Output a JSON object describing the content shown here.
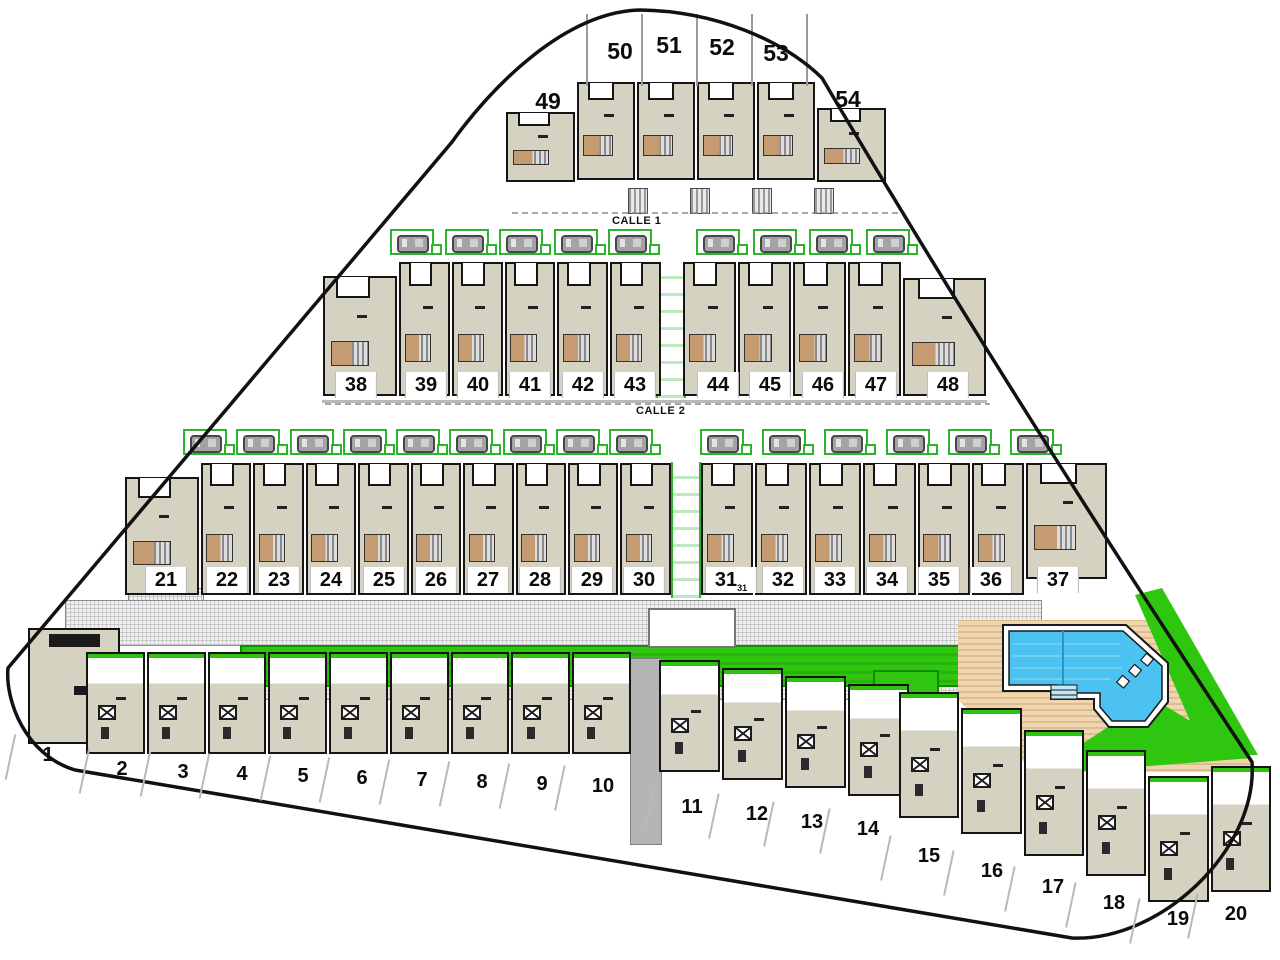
{
  "site": {
    "type": "residential-site-plan",
    "streets": [
      {
        "label": "CALLE 1"
      },
      {
        "label": "CALLE 2"
      }
    ],
    "total_plots": 54
  },
  "plots": {
    "rowA": {
      "plots": [
        {
          "n": "49",
          "x": 548,
          "y": 88
        },
        {
          "n": "50",
          "x": 620,
          "y": 38
        },
        {
          "n": "51",
          "x": 669,
          "y": 32
        },
        {
          "n": "52",
          "x": 722,
          "y": 34
        },
        {
          "n": "53",
          "x": 776,
          "y": 40
        },
        {
          "n": "54",
          "x": 848,
          "y": 86
        }
      ]
    },
    "rowB_left": {
      "plots": [
        {
          "n": "38",
          "x": 356,
          "y": 372
        },
        {
          "n": "39",
          "x": 426,
          "y": 372
        },
        {
          "n": "40",
          "x": 478,
          "y": 372
        },
        {
          "n": "41",
          "x": 530,
          "y": 372
        },
        {
          "n": "42",
          "x": 583,
          "y": 372
        },
        {
          "n": "43",
          "x": 635,
          "y": 372
        }
      ]
    },
    "rowB_right": {
      "plots": [
        {
          "n": "44",
          "x": 718,
          "y": 372
        },
        {
          "n": "45",
          "x": 770,
          "y": 372
        },
        {
          "n": "46",
          "x": 823,
          "y": 372
        },
        {
          "n": "47",
          "x": 876,
          "y": 372
        },
        {
          "n": "48",
          "x": 948,
          "y": 372
        }
      ]
    },
    "rowC_left": {
      "plots": [
        {
          "n": "21",
          "x": 166,
          "y": 567
        },
        {
          "n": "22",
          "x": 227,
          "y": 567
        },
        {
          "n": "23",
          "x": 279,
          "y": 567
        },
        {
          "n": "24",
          "x": 331,
          "y": 567
        },
        {
          "n": "25",
          "x": 384,
          "y": 567
        },
        {
          "n": "26",
          "x": 436,
          "y": 567
        },
        {
          "n": "27",
          "x": 488,
          "y": 567
        },
        {
          "n": "28",
          "x": 540,
          "y": 567
        },
        {
          "n": "29",
          "x": 592,
          "y": 567
        },
        {
          "n": "30",
          "x": 644,
          "y": 567
        }
      ]
    },
    "rowC_right": {
      "plots": [
        {
          "n": "31",
          "sub": "31",
          "x": 731,
          "y": 567
        },
        {
          "n": "32",
          "x": 783,
          "y": 567
        },
        {
          "n": "33",
          "x": 835,
          "y": 567
        },
        {
          "n": "34",
          "x": 887,
          "y": 567
        },
        {
          "n": "35",
          "x": 939,
          "y": 567
        },
        {
          "n": "36",
          "x": 991,
          "y": 567
        },
        {
          "n": "37",
          "x": 1058,
          "y": 567
        }
      ]
    },
    "rowD1": {
      "plots": [
        {
          "n": "1",
          "x": 48,
          "y": 742
        }
      ]
    },
    "rowD": {
      "plots": [
        {
          "n": "2",
          "x": 122,
          "y": 756
        },
        {
          "n": "3",
          "x": 183,
          "y": 759
        },
        {
          "n": "4",
          "x": 242,
          "y": 761
        },
        {
          "n": "5",
          "x": 303,
          "y": 763
        },
        {
          "n": "6",
          "x": 362,
          "y": 765
        },
        {
          "n": "7",
          "x": 422,
          "y": 767
        },
        {
          "n": "8",
          "x": 482,
          "y": 769
        },
        {
          "n": "9",
          "x": 542,
          "y": 771
        },
        {
          "n": "10",
          "x": 603,
          "y": 773
        }
      ]
    },
    "rowE": {
      "plots": [
        {
          "n": "11",
          "x": 692,
          "y": 794
        },
        {
          "n": "12",
          "x": 757,
          "y": 801
        },
        {
          "n": "13",
          "x": 812,
          "y": 809
        },
        {
          "n": "14",
          "x": 868,
          "y": 816
        }
      ]
    },
    "rowF": {
      "plots": [
        {
          "n": "15",
          "x": 929,
          "y": 843
        },
        {
          "n": "16",
          "x": 992,
          "y": 858
        },
        {
          "n": "17",
          "x": 1053,
          "y": 874
        },
        {
          "n": "18",
          "x": 1114,
          "y": 890
        },
        {
          "n": "19",
          "x": 1178,
          "y": 906
        },
        {
          "n": "20",
          "x": 1236,
          "y": 901
        }
      ]
    }
  },
  "parking": {
    "calle1_left": [
      {},
      {},
      {},
      {},
      {}
    ],
    "calle1_right": [
      {},
      {},
      {},
      {}
    ],
    "calle2_left": [
      {},
      {},
      {},
      {},
      {},
      {},
      {},
      {},
      {}
    ],
    "calle2_right": [
      {},
      {},
      {},
      {},
      {},
      {}
    ]
  },
  "amenities": {
    "pool": "swimming-pool",
    "pool_deck": "timber-deck",
    "lawn": "green-area",
    "promenade": "paved-walkway"
  },
  "colors": {
    "boundary": "#111111",
    "house_fill": "#d6d2c2",
    "house_outline": "#151515",
    "patio_brown": "#c59b72",
    "lawn_green": "#2fc60f",
    "parking_green": "#2db32d",
    "pool_blue": "#4cc2f1",
    "deck_tan": "#ecd2ab",
    "walkway_gray": "#c7c7c7"
  }
}
